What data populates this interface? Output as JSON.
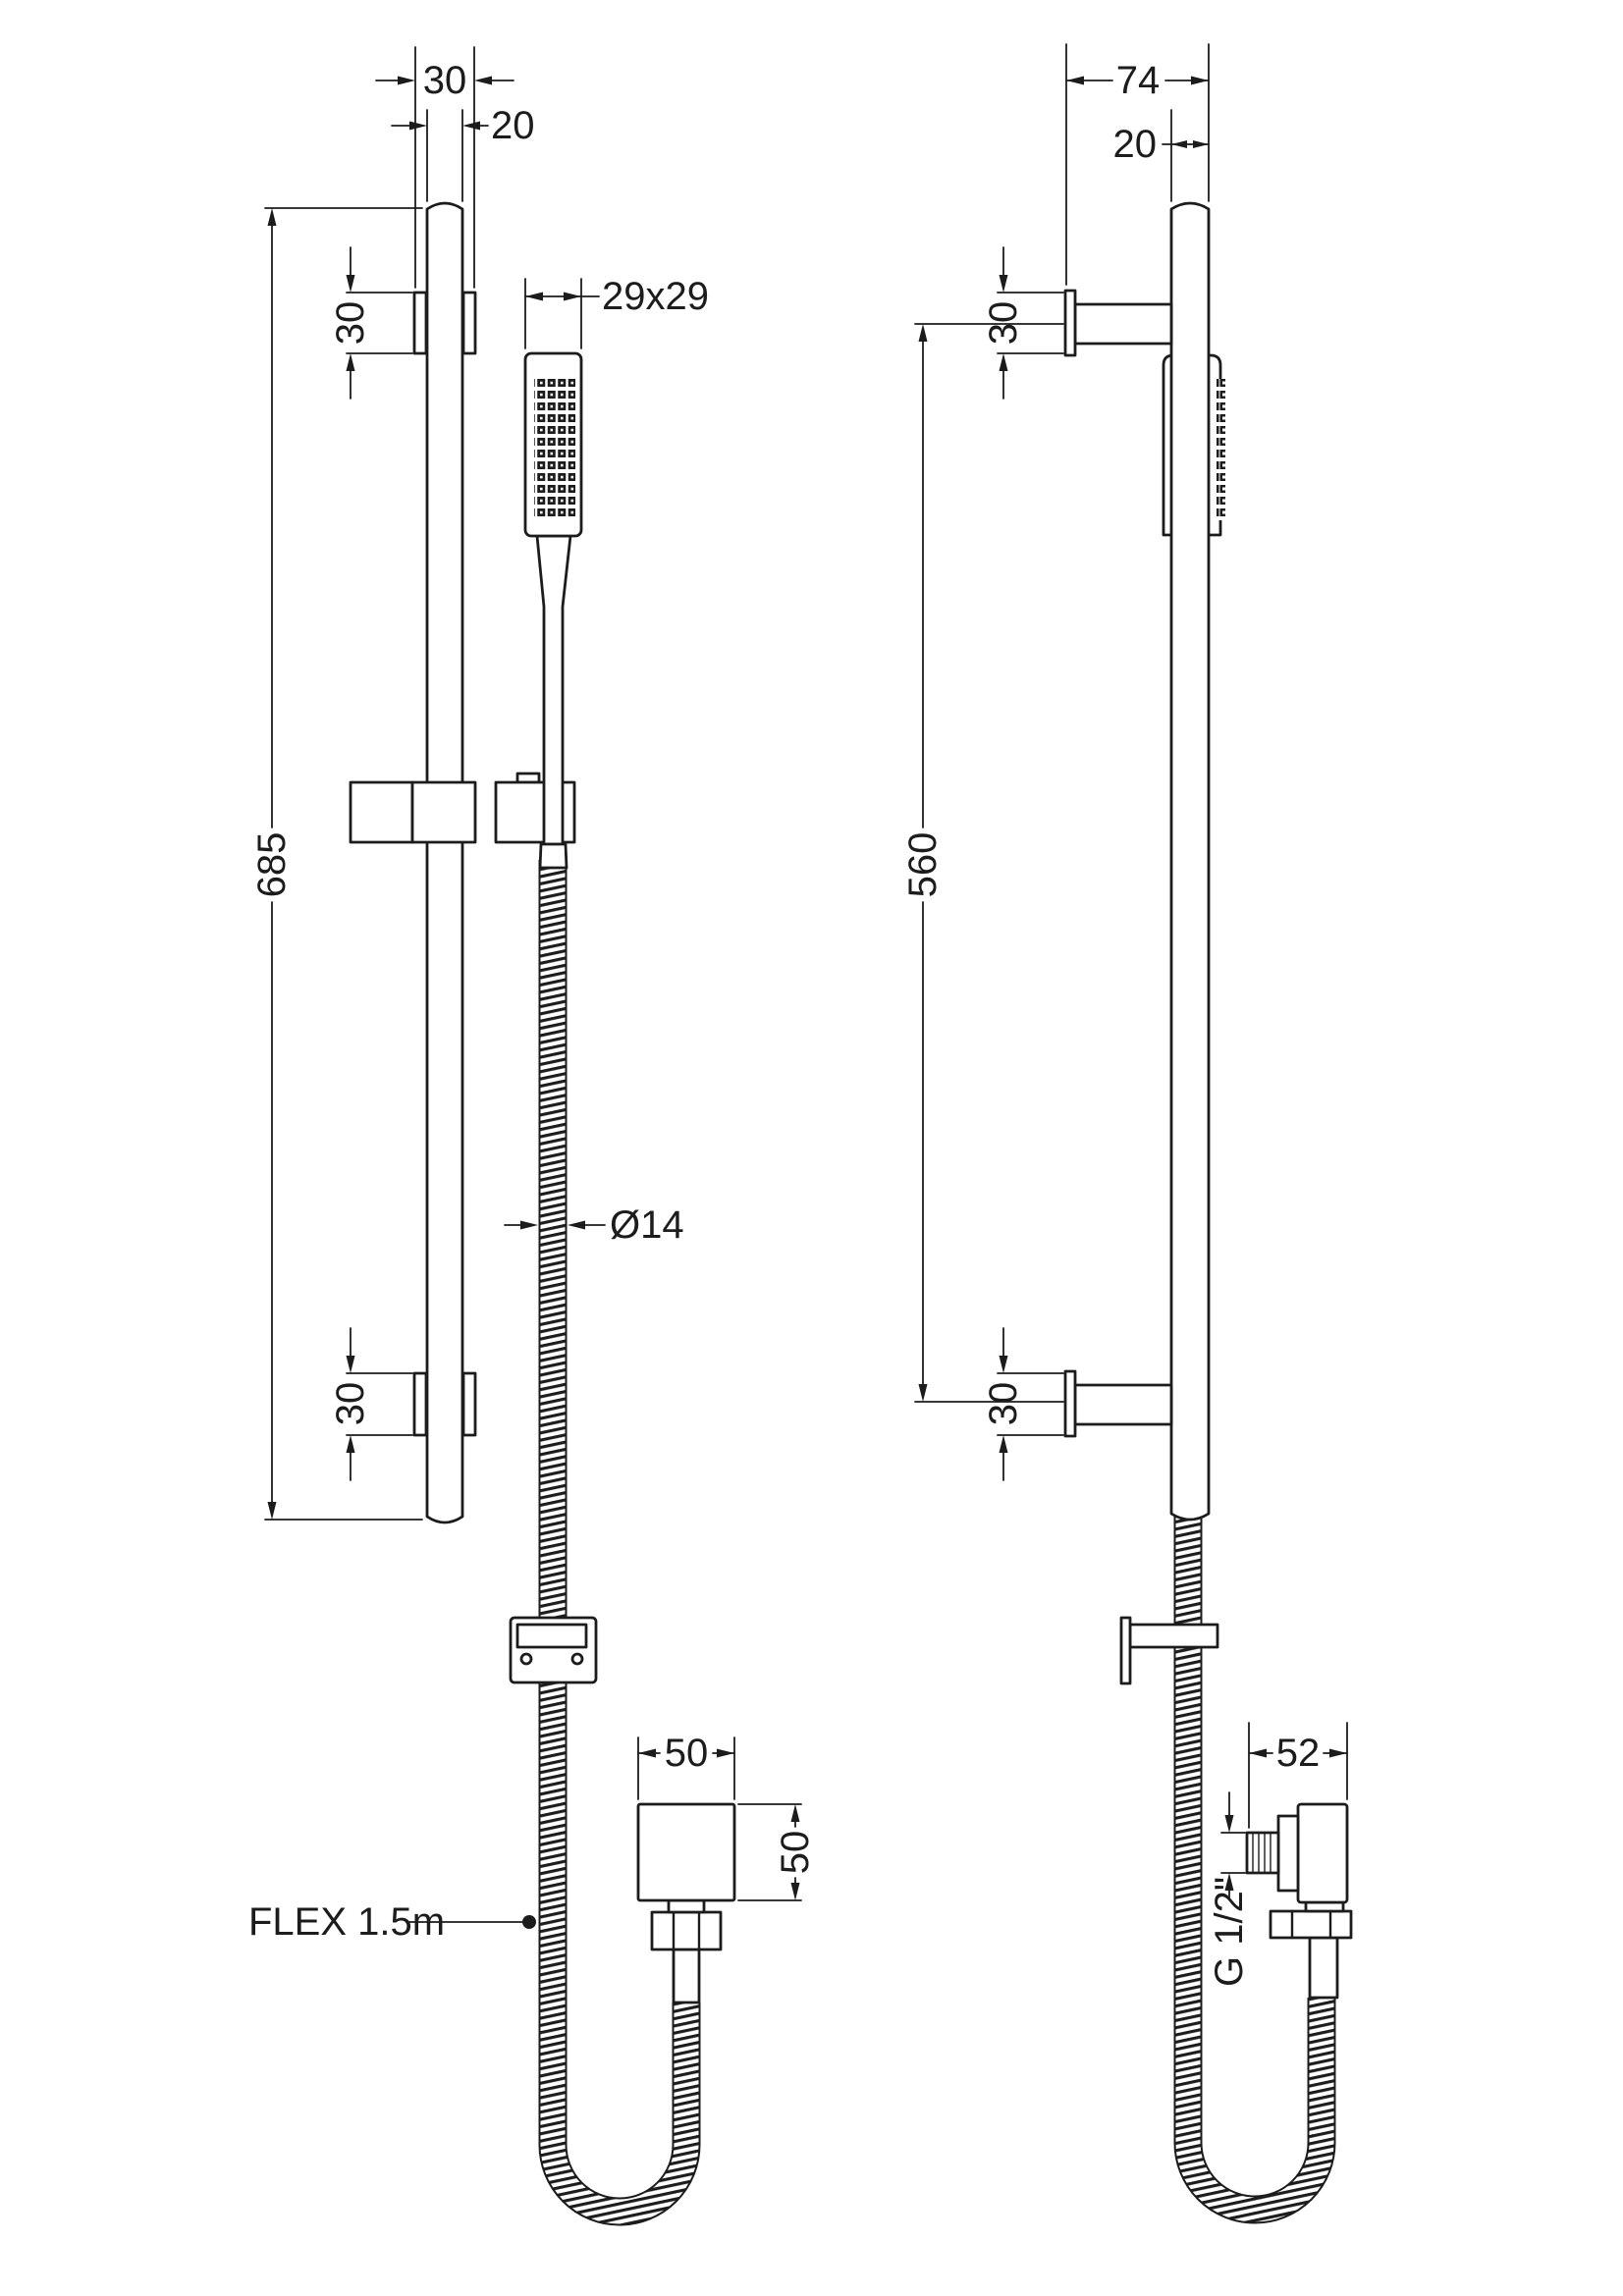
{
  "page": {
    "background": "#ffffff",
    "line_color": "#1c1c1c",
    "description": "Technical dimension drawing of shower slide rail kit, front and side elevations"
  },
  "front_view": {
    "dim_bracket_width": "30",
    "dim_rail_width": "20",
    "dim_handset_face": "29x29",
    "dim_bracket_top_height": "30",
    "dim_rail_length": "685",
    "dim_bracket_bottom_height": "30",
    "dim_hose_diameter": "Ø14",
    "dim_outlet_width": "50",
    "dim_outlet_height": "50",
    "label_hose_length": "FLEX 1.5m"
  },
  "side_view": {
    "dim_wall_offset": "74",
    "dim_rail_depth": "20",
    "dim_bracket_top_height": "30",
    "dim_bracket_centres": "560",
    "dim_bracket_bottom_height": "30",
    "dim_outlet_depth": "52",
    "label_thread": "G 1/2\""
  }
}
